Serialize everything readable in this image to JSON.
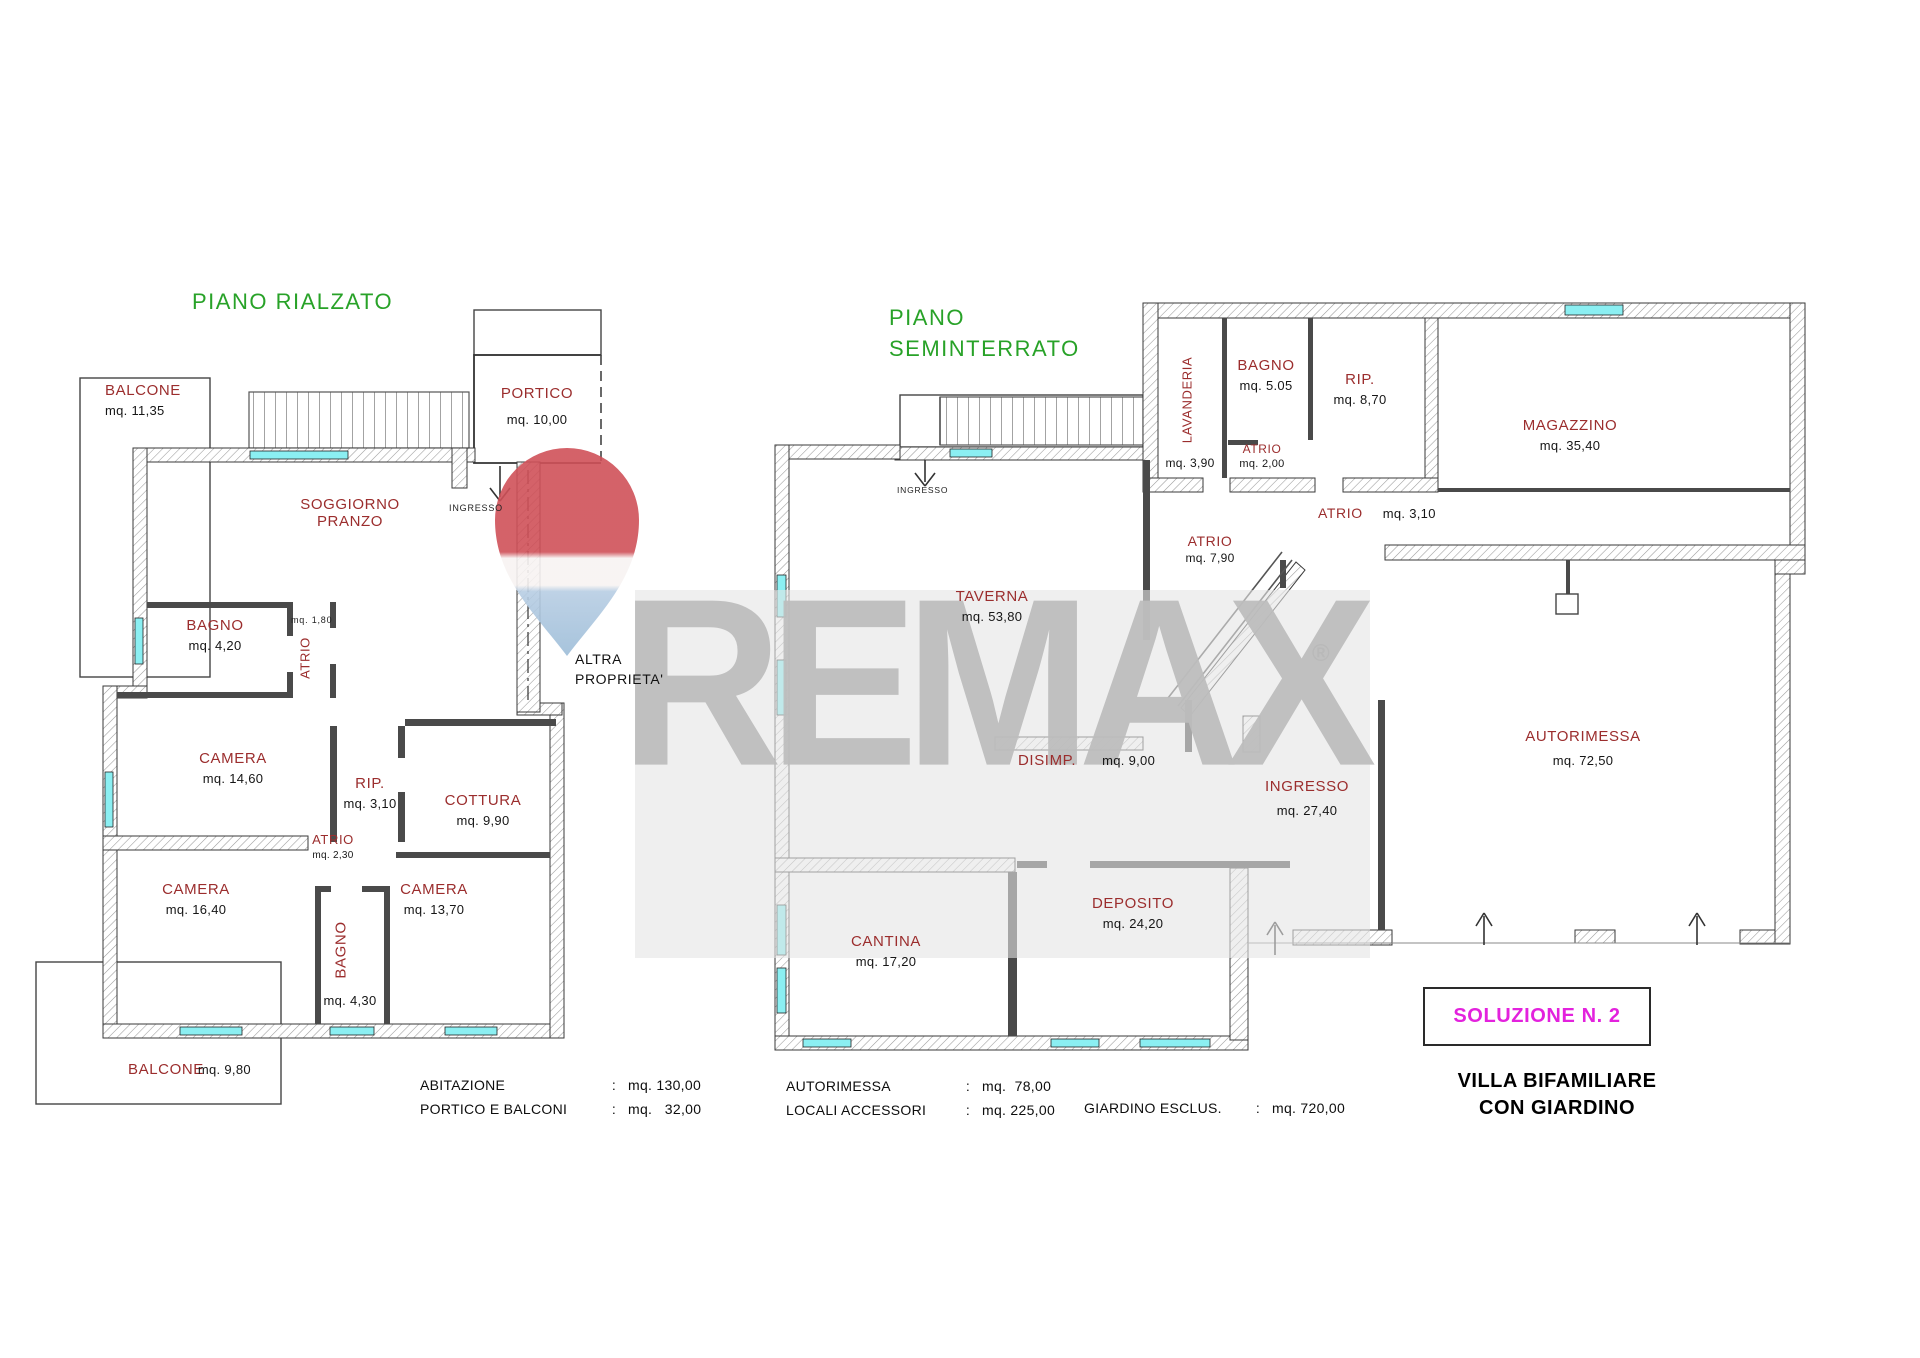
{
  "watermark": {
    "brand": "REMAX",
    "reg": "®"
  },
  "floor_left": {
    "title": "PIANO RIALZATO",
    "rooms": {
      "balcone_top": {
        "name": "BALCONE",
        "area": "mq. 11,35"
      },
      "portico": {
        "name": "PORTICO",
        "area": "mq. 10,00"
      },
      "soggiorno": {
        "line1": "SOGGIORNO",
        "line2": "PRANZO"
      },
      "ingresso": {
        "name": "INGRESSO"
      },
      "bagno": {
        "name": "BAGNO",
        "area": "mq. 4,20"
      },
      "atrio1": {
        "name": "ATRIO",
        "area": "mq. 1,80"
      },
      "camera1": {
        "name": "CAMERA",
        "area": "mq. 14,60"
      },
      "rip": {
        "name": "RIP.",
        "area": "mq. 3,10"
      },
      "cottura": {
        "name": "COTTURA",
        "area": "mq. 9,90"
      },
      "atrio2": {
        "name": "ATRIO",
        "area": "mq. 2,30"
      },
      "camera2": {
        "name": "CAMERA",
        "area": "mq. 16,40"
      },
      "bagno2": {
        "name": "BAGNO",
        "area": "mq. 4,30"
      },
      "camera3": {
        "name": "CAMERA",
        "area": "mq. 13,70"
      },
      "balcone_bottom": {
        "name": "BALCONE",
        "area": "mq. 9,80"
      },
      "altra": {
        "line1": "ALTRA",
        "line2": "PROPRIETA'"
      }
    },
    "summary": {
      "rows": [
        {
          "label": "ABITAZIONE",
          "sep": ":",
          "value": "mq. 130,00"
        },
        {
          "label": "PORTICO E BALCONI",
          "sep": ":",
          "value": "mq.   32,00"
        }
      ]
    }
  },
  "floor_right": {
    "title_line1": "PIANO",
    "title_line2": "SEMINTERRATO",
    "rooms": {
      "lavanderia": {
        "name": "LAVANDERIA",
        "area": "mq. 3,90"
      },
      "bagno": {
        "name": "BAGNO",
        "area": "mq. 5.05"
      },
      "atrio_small": {
        "name": "ATRIO",
        "area": "mq. 2,00"
      },
      "rip": {
        "name": "RIP.",
        "area": "mq. 8,70"
      },
      "magazzino": {
        "name": "MAGAZZINO",
        "area": "mq.  35,40"
      },
      "atrio310": {
        "name": "ATRIO",
        "area": "mq. 3,10"
      },
      "atrio790": {
        "name": "ATRIO",
        "area": "mq. 7,90"
      },
      "ingresso_stairs": {
        "name": "INGRESSO"
      },
      "taverna": {
        "name": "TAVERNA",
        "area": "mq. 53,80"
      },
      "disimp": {
        "name": "DISIMP.",
        "area": "mq. 9,00"
      },
      "ingresso": {
        "name": "INGRESSO",
        "area": "mq. 27,40"
      },
      "autorimessa": {
        "name": "AUTORIMESSA",
        "area": "mq. 72,50"
      },
      "cantina": {
        "name": "CANTINA",
        "area": "mq. 17,20"
      },
      "deposito": {
        "name": "DEPOSITO",
        "area": "mq. 24,20"
      }
    },
    "summary": {
      "rows": [
        {
          "label": "AUTORIMESSA",
          "sep": ":",
          "value": "mq.  78,00"
        },
        {
          "label": "LOCALI ACCESSORI",
          "sep": ":",
          "value": "mq. 225,00"
        }
      ]
    },
    "summary2": {
      "rows": [
        {
          "label": "GIARDINO ESCLUS.",
          "sep": ":",
          "value": "mq. 720,00"
        }
      ]
    }
  },
  "footer": {
    "solution": "SOLUZIONE N. 2",
    "subtitle_line1": "VILLA BIFAMILIARE",
    "subtitle_line2": "CON GIARDINO"
  }
}
